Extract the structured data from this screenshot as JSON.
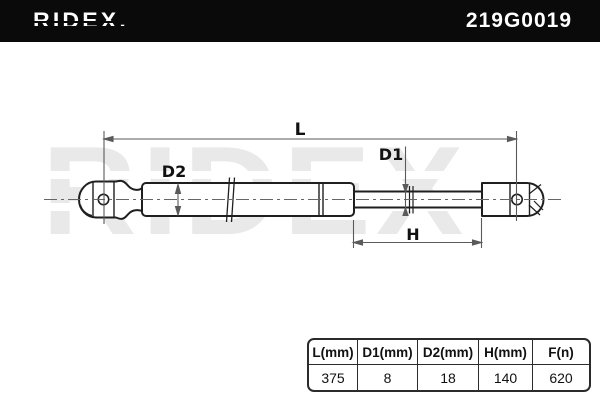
{
  "header": {
    "brand": "RIDEX.",
    "part_number": "219G0019"
  },
  "watermark": {
    "text": "RIDEX"
  },
  "diagram": {
    "component": "gas-spring",
    "labels": {
      "total_length": "L",
      "rod_diameter": "D1",
      "cylinder_diameter": "D2",
      "rod_length": "H"
    }
  },
  "spec_table": {
    "columns": [
      "L(mm)",
      "D1(mm)",
      "D2(mm)",
      "H(mm)",
      "F(n)"
    ],
    "values": [
      "375",
      "8",
      "18",
      "140",
      "620"
    ]
  },
  "colors": {
    "header_bg": "#0a0a0a",
    "header_text": "#ffffff",
    "outline": "#1f1f1f",
    "dimension": "#5a5a5a",
    "watermark": "#e9e9e9"
  }
}
